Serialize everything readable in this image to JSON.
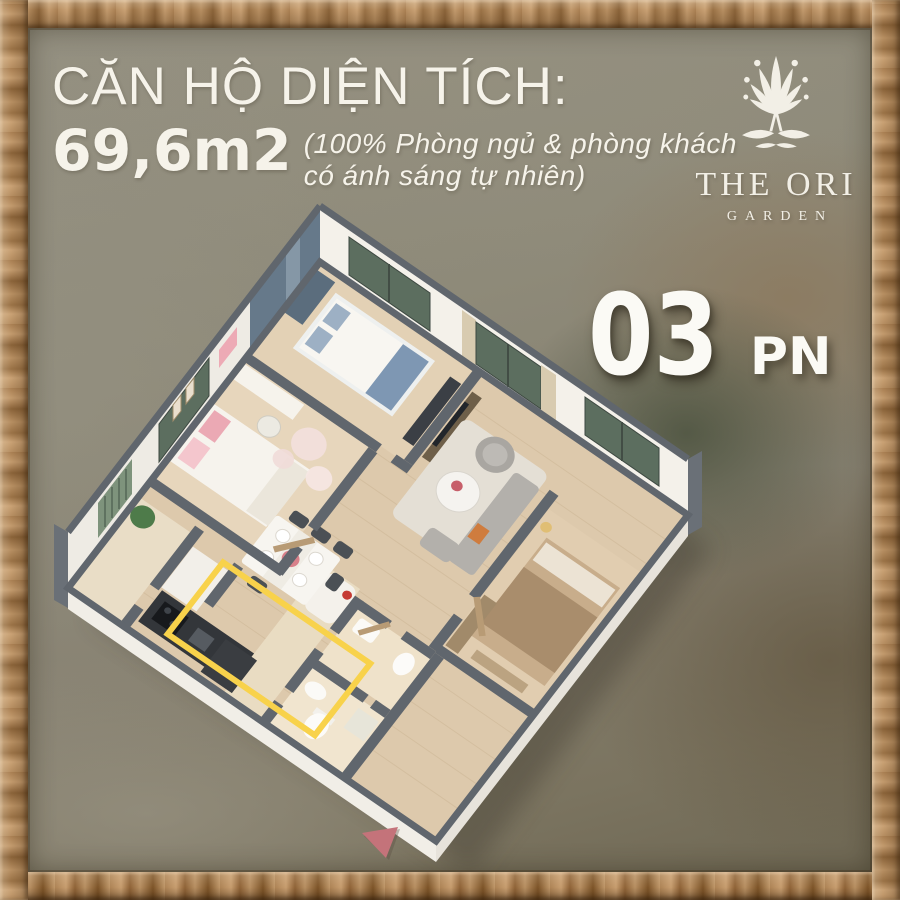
{
  "header": {
    "title": "CĂN HỘ DIỆN TÍCH:",
    "area": "69,6m2",
    "note_line1": "(100% Phòng ngủ & phòng khách",
    "note_line2": "có ánh sáng tự nhiên)"
  },
  "logo": {
    "title": "THE ORI",
    "subtitle": "GARDEN"
  },
  "badge": {
    "number": "03",
    "unit": "PN"
  },
  "colors": {
    "highlight": "#F8D24B",
    "wall_gray": "#60666D",
    "window_green": "#5C6E5F",
    "marker": "#C4737A",
    "text": "#F6F3EA",
    "frame_wood": "#B48C60"
  }
}
